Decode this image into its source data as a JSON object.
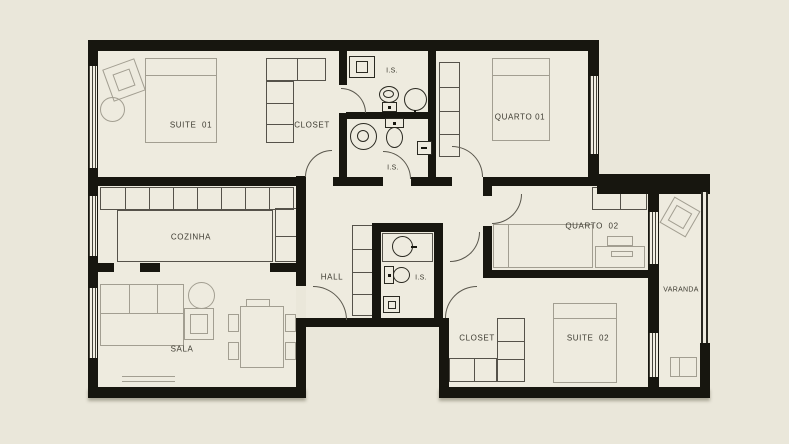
{
  "colors": {
    "background": "#eae7da",
    "floor": "#eeebdf",
    "wall": "#17160f",
    "furniture_line": "#a29e91",
    "cabinet_line": "#55524a",
    "fixture_line": "#2a2921",
    "label_text": "#3c3a30"
  },
  "plan_type": "apartment floor plan",
  "rooms": [
    {
      "id": "suite-01",
      "label": "SUITE  01"
    },
    {
      "id": "closet-suite-01",
      "label": "CLOSET"
    },
    {
      "id": "is-upper",
      "label": "I.S."
    },
    {
      "id": "is-lower",
      "label": "I.S."
    },
    {
      "id": "quarto-01",
      "label": "QUARTO 01"
    },
    {
      "id": "cozinha",
      "label": "COZINHA"
    },
    {
      "id": "hall",
      "label": "HALL"
    },
    {
      "id": "is-hall",
      "label": "I.S."
    },
    {
      "id": "quarto-02",
      "label": "QUARTO  02"
    },
    {
      "id": "varanda",
      "label": "VARANDA"
    },
    {
      "id": "sala",
      "label": "SALA"
    },
    {
      "id": "closet-suite-02",
      "label": "CLOSET"
    },
    {
      "id": "suite-02",
      "label": "SUITE  02"
    }
  ]
}
